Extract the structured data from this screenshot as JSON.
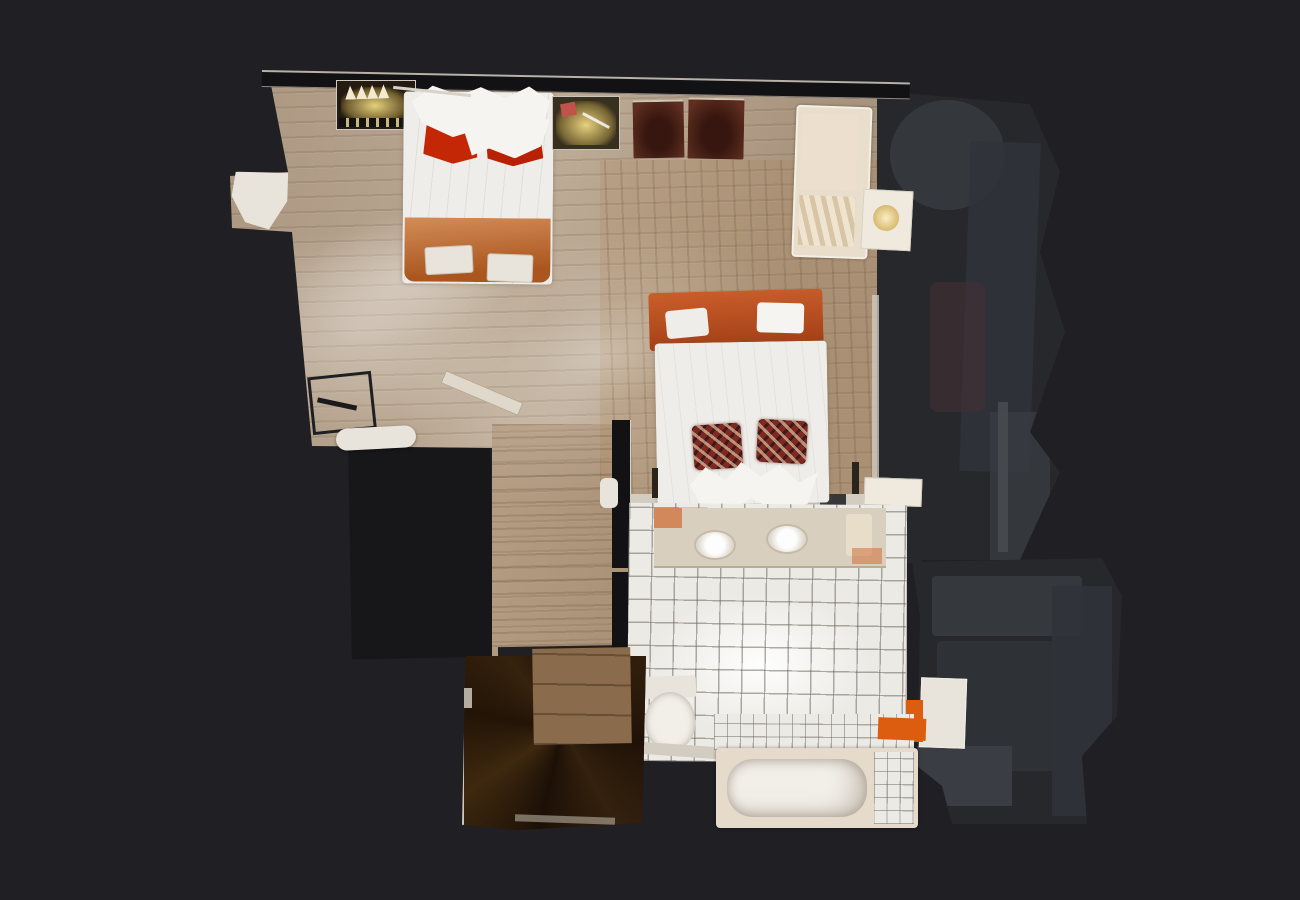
{
  "view": {
    "type": "dollhouse-top-down-3d-scan",
    "description": "Top-down 3D scan view of an apartment floor on a dark backdrop"
  },
  "colors": {
    "background": "#1f1f24",
    "wall_dark": "#121215",
    "wall_light": "#d3ccc1",
    "wood_base": "#b6a38d",
    "bed2_floor_tint": "rgba(173,128,82,0.20)",
    "hall_floor_tint": "rgba(150,113,72,0.26)",
    "under_shadow": "#17171a",
    "dim_room": "#26282c",
    "dim_blob": "#3a3d43",
    "dim_blob_soft": "#303339",
    "dim_blob_warm": "#423136",
    "stairs_dark": "#241508",
    "landing_wood": "#8a6c4c",
    "tile_base": "#eceae5",
    "duvet_white": "#efede9",
    "scrunch_white": "#f6f4f0",
    "pillow_red": "#c42706",
    "pillow_red_dark": "#b82103",
    "blanket_orange": "#bc6226",
    "headboard_orange": "#b8481a",
    "plaid_base": "#7e2822",
    "ottoman_brown": "#54281c",
    "sofa_cream": "#e8decb",
    "nightstand_white": "#efe9de",
    "vanity_top": "#d9cfbf",
    "porcelain": "#f2efe9",
    "tub_surround": "#e6dacb",
    "accent_orange": "#dd5d10",
    "wardrobe_dark": "#241c12",
    "table_dark": "#38301f",
    "white_object": "#e9e4db",
    "card_red": "#c0544a",
    "lamp_glow": "#e9d385"
  },
  "rooms": [
    {
      "name": "bedroom-1",
      "floor": "light oak planks"
    },
    {
      "name": "bedroom-2",
      "floor": "oak planks"
    },
    {
      "name": "hallway",
      "floor": "oak planks"
    },
    {
      "name": "bathroom",
      "floor": "white square tiles"
    },
    {
      "name": "staircase",
      "floor": "dark winder stairs"
    },
    {
      "name": "adjacent-rooms-right",
      "state": "unlit, in shadow"
    }
  ],
  "furniture": {
    "bedroom_1": [
      "wardrobe with hangers",
      "double bed with white duvet",
      "red pillows",
      "orange foot blanket",
      "breakfast trays",
      "lit glass table",
      "two leather ottomans",
      "cream sofa",
      "nightstand with lamp",
      "dark desk chair",
      "white floor roll",
      "leaning board"
    ],
    "bedroom_2": [
      "double bed",
      "orange headboard",
      "white duvet",
      "two tartan pillows",
      "white nightstand"
    ],
    "bathroom": [
      "double-sink vanity",
      "toilet",
      "bathtub",
      "orange towel",
      "white shelf unit"
    ]
  }
}
